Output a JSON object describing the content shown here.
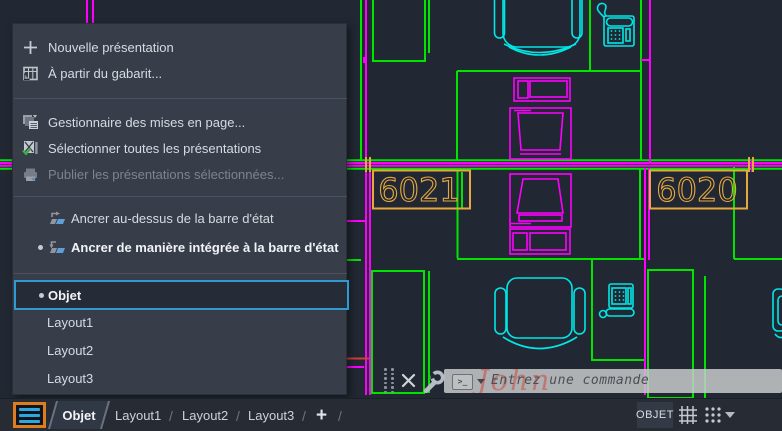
{
  "menu": {
    "items": [
      {
        "label": "Nouvelle présentation"
      },
      {
        "label": "À partir du gabarit..."
      },
      {
        "label": "Gestionnaire des mises en page..."
      },
      {
        "label": "Sélectionner toutes les présentations"
      },
      {
        "label": "Publier les présentations sélectionnées...",
        "disabled": true
      },
      {
        "label": "Ancrer au-dessus de la barre d'état"
      },
      {
        "label": "Ancrer de manière intégrée à la barre d'état",
        "bold": true,
        "bullet": true
      },
      {
        "label": "Objet",
        "selected": true,
        "bullet": true,
        "bold": true
      },
      {
        "label": "Layout1"
      },
      {
        "label": "Layout2"
      },
      {
        "label": "Layout3"
      }
    ]
  },
  "drawing": {
    "room_labels": [
      {
        "text": "6021"
      },
      {
        "text": "6020"
      }
    ],
    "ghost_annotation": "John",
    "colors": {
      "background": "#222833",
      "walls_green": "#00e400",
      "furniture_magenta": "#ff00ff",
      "equipment_cyan": "#00e6e6",
      "labels_orange": "#e7a83e",
      "annotation_red": "#d04038"
    }
  },
  "command_bar": {
    "prompt_icon": ">_",
    "placeholder": "Entrez une commande"
  },
  "status_bar": {
    "tabs": [
      "Objet",
      "Layout1",
      "Layout2",
      "Layout3"
    ],
    "tab_separator": "/",
    "add_tab": "+",
    "paper_space_button": "OBJET"
  }
}
